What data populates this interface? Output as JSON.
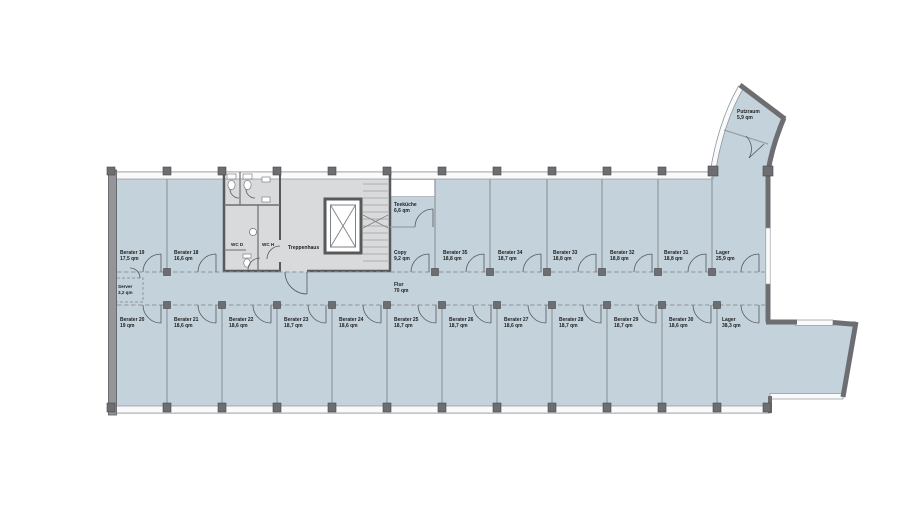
{
  "plan": {
    "type": "floor-plan",
    "corridor": {
      "name": "Flur",
      "area": "70 qm"
    }
  },
  "colors": {
    "room_fill": "#c3d2db",
    "core_fill": "#d9dadb",
    "wall_dark": "#6d6e71",
    "wall_light": "#98a0a7",
    "window_fill": "#fafafa",
    "text": "#1f1f1f"
  },
  "rooms": {
    "b19": {
      "name": "Berater 19",
      "area": "17,5 qm"
    },
    "b18": {
      "name": "Berater 18",
      "area": "16,6 qm"
    },
    "wcd": {
      "name": "WC D"
    },
    "wch": {
      "name": "WC H"
    },
    "treppenhaus": {
      "name": "Treppenhaus"
    },
    "teekueche": {
      "name": "Teeküche",
      "area": "6,6 qm"
    },
    "copy": {
      "name": "Copy",
      "area": "9,2 qm"
    },
    "b35": {
      "name": "Berater 35",
      "area": "18,8 qm"
    },
    "b34": {
      "name": "Berater 34",
      "area": "18,7 qm"
    },
    "b33": {
      "name": "Berater 33",
      "area": "18,8 qm"
    },
    "b32": {
      "name": "Berater 32",
      "area": "18,8 qm"
    },
    "b31": {
      "name": "Berater 31",
      "area": "18,8 qm"
    },
    "lager_top": {
      "name": "Lager",
      "area": "25,9 qm"
    },
    "putzraum": {
      "name": "Putzraum",
      "area": "5,9 qm"
    },
    "server": {
      "name": "Server",
      "area": "3,2 qm"
    },
    "flur": {
      "name": "Flur",
      "area": "70 qm"
    },
    "b20": {
      "name": "Berater 20",
      "area": "19 qm"
    },
    "b21": {
      "name": "Berater 21",
      "area": "18,6 qm"
    },
    "b22": {
      "name": "Berater 22",
      "area": "18,6 qm"
    },
    "b23": {
      "name": "Berater 23",
      "area": "18,7 qm"
    },
    "b24": {
      "name": "Berater 24",
      "area": "18,6 qm"
    },
    "b25": {
      "name": "Berater 25",
      "area": "18,7 qm"
    },
    "b26": {
      "name": "Berater 26",
      "area": "18,7 qm"
    },
    "b27": {
      "name": "Berater 27",
      "area": "18,6 qm"
    },
    "b28": {
      "name": "Berater 28",
      "area": "18,7 qm"
    },
    "b29": {
      "name": "Berater 29",
      "area": "18,7 qm"
    },
    "b30": {
      "name": "Berater 30",
      "area": "18,6 qm"
    },
    "lager_bottom": {
      "name": "Lager",
      "area": "38,3 qm"
    }
  }
}
